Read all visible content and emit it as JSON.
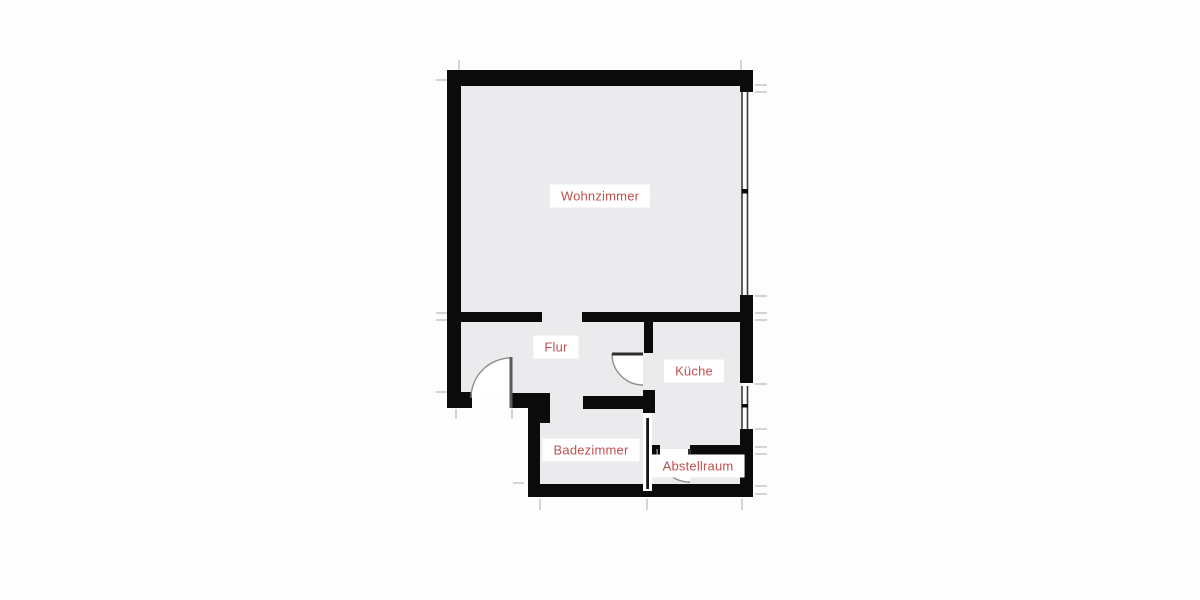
{
  "floorplan": {
    "rooms": {
      "wohnzimmer": {
        "label": "Wohnzimmer"
      },
      "flur": {
        "label": "Flur"
      },
      "kueche": {
        "label": "Küche"
      },
      "badezimmer": {
        "label": "Badezimmer"
      },
      "abstellraum": {
        "label": "Abstellraum"
      }
    }
  },
  "colors": {
    "canvas-bg": "#fdfdfd",
    "floor": "#ebebed",
    "wall": "#0b0b0b",
    "window-line": "#3a3a3a",
    "door-line": "#8f8f8f",
    "tick": "#c9c9c9",
    "label-bg": "#ffffff",
    "label-text": "#c0504d"
  }
}
